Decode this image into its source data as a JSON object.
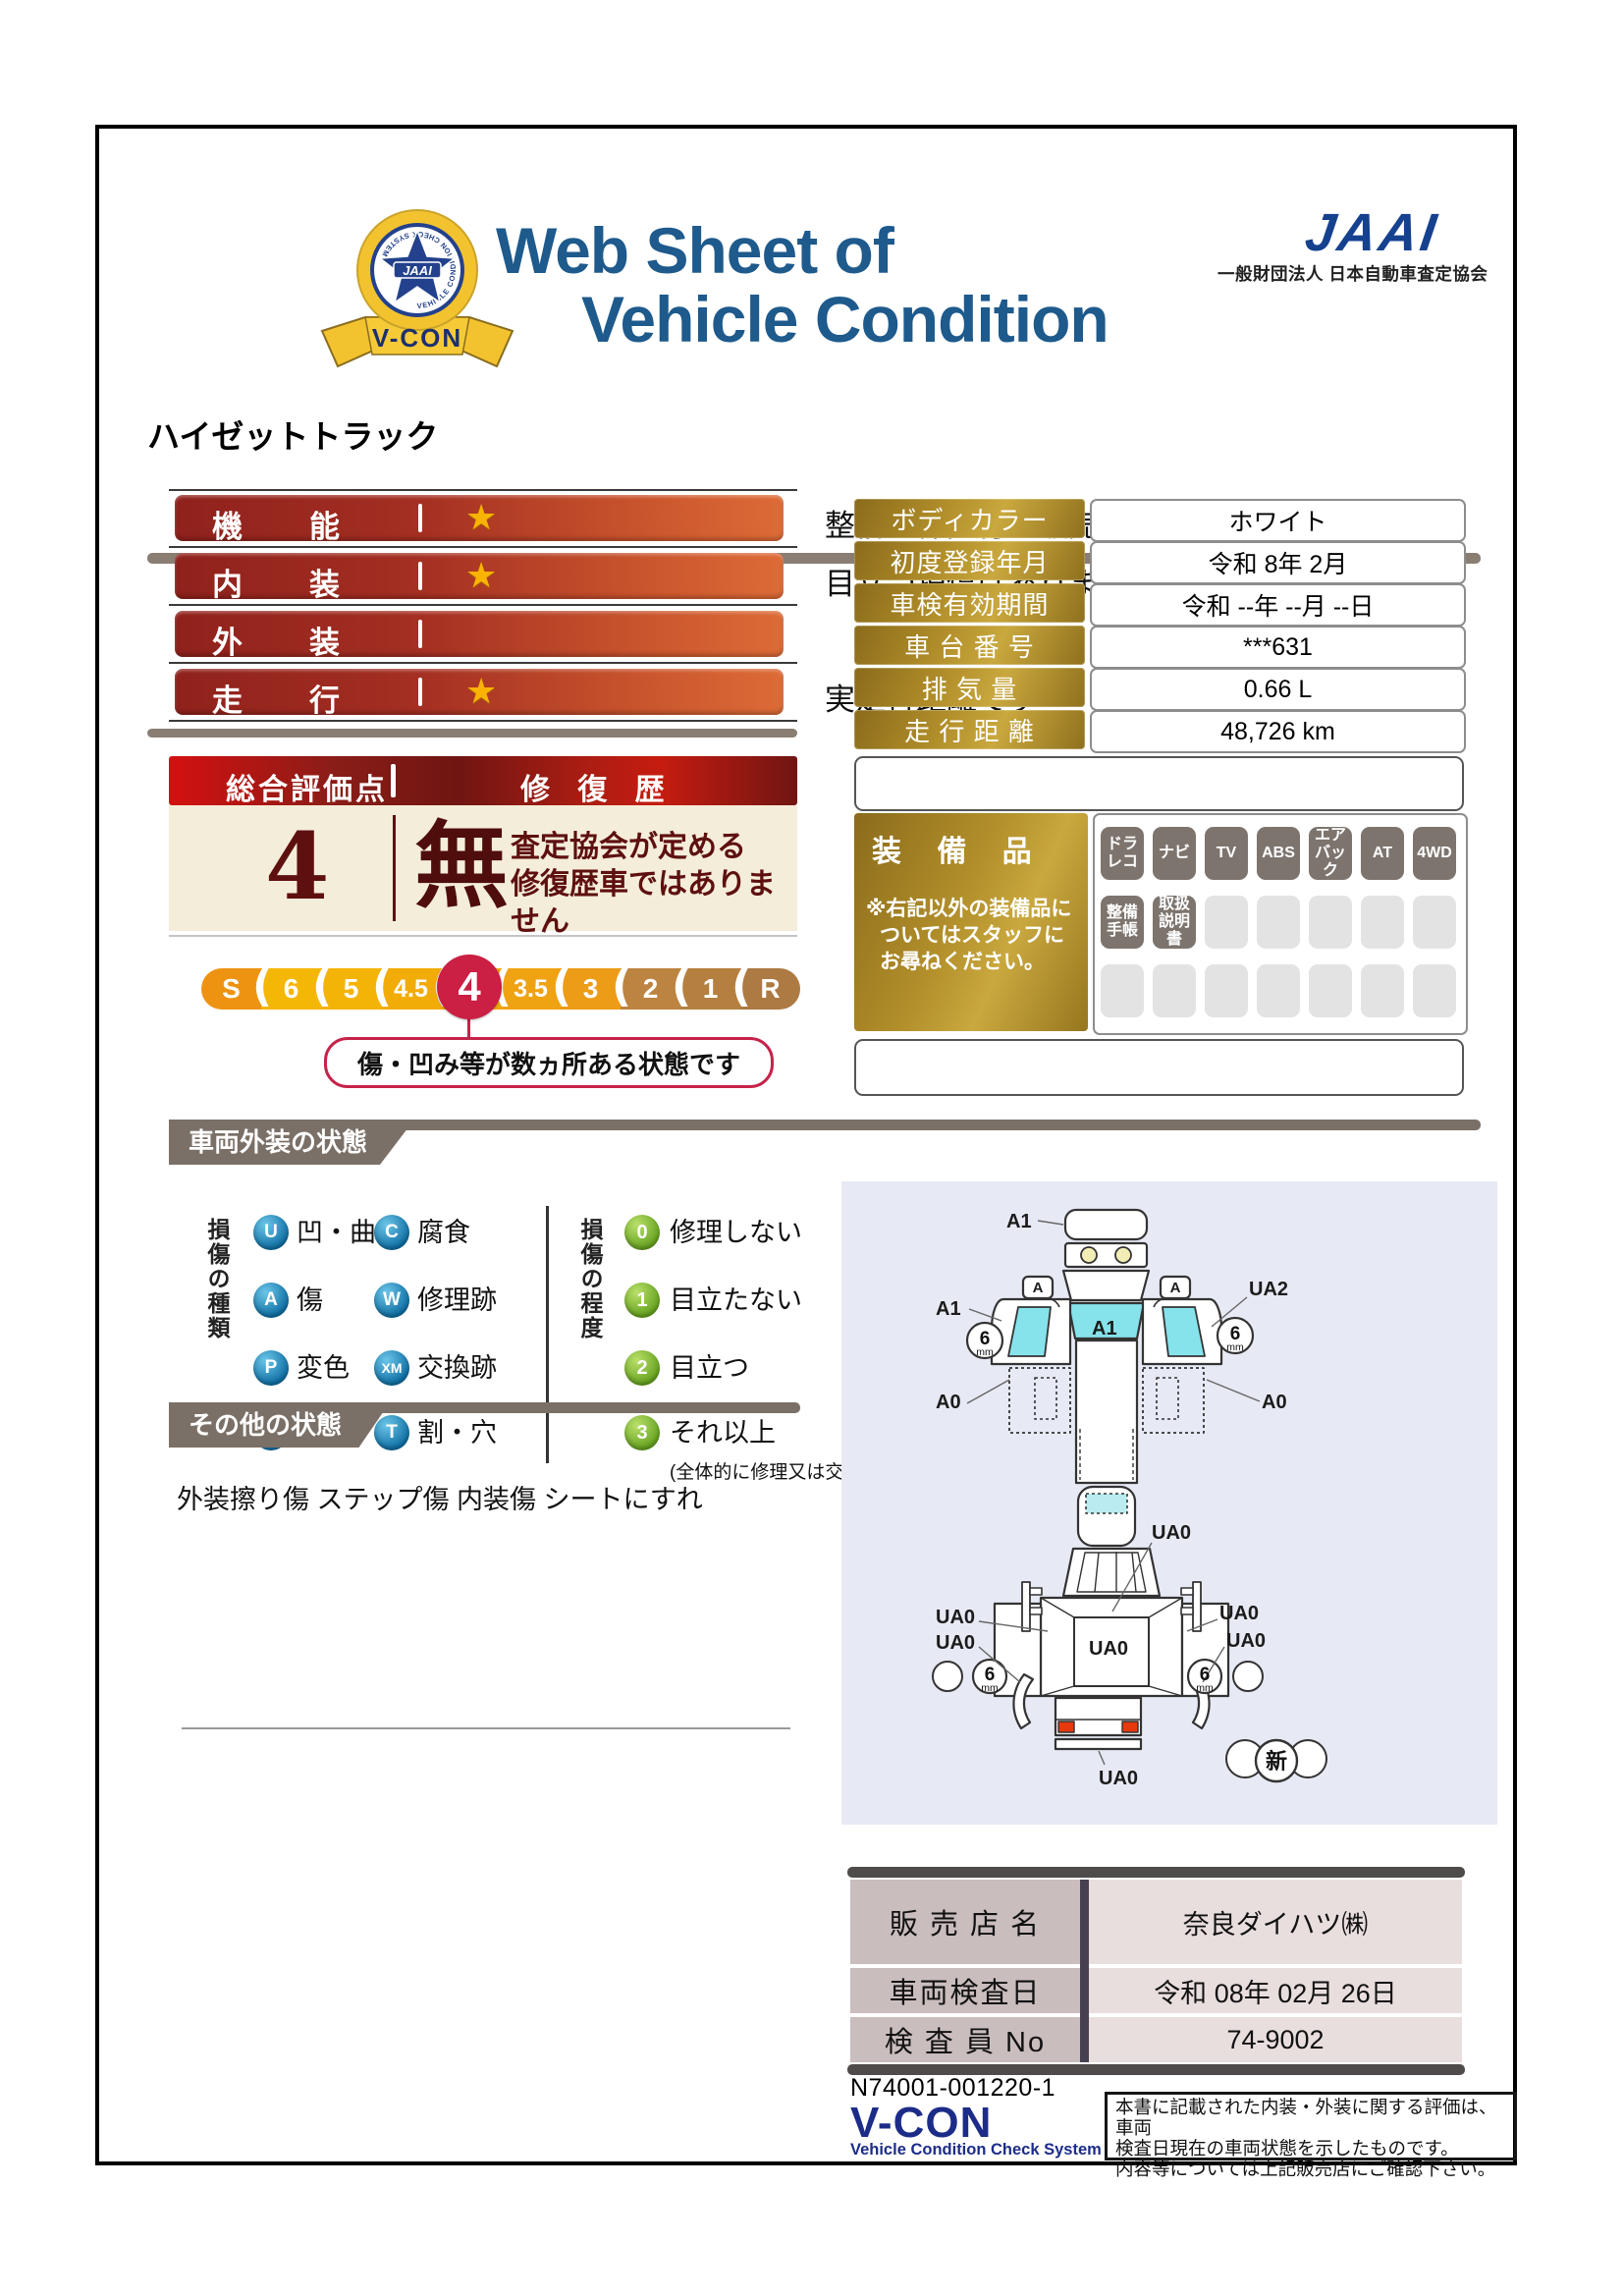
{
  "colors": {
    "navy_title": "#1e5a8c",
    "jaai_blue": "#16418f",
    "bar_red": "#8f211c",
    "bar_orange": "#dd6b37",
    "crimson": "#cb1f43",
    "gold": "#b3902b",
    "tab_gray": "#7b7067",
    "cream": "#f4edda",
    "maroon": "#5e100f",
    "diagram_bg": "#e7e9f4",
    "glass_cyan": "#86e3eb",
    "badge_blue": "#0f6fa4",
    "badge_green": "#66a21f"
  },
  "header": {
    "title_line1": "Web Sheet of",
    "title_line2": "Vehicle Condition",
    "badge": {
      "center": "JAAI",
      "ring_text": "VEHICLE CONDITION CHECK SYSTEM",
      "ribbon": "V-CON"
    },
    "jaai_logo": "JAAI",
    "jaai_org": "一般財団法人 日本自動車査定協会"
  },
  "vehicle_name": "ハイゼットトラック",
  "ratings": {
    "star_glyph": "★",
    "rows": [
      {
        "label": "機能",
        "star": true,
        "comment": "整備・保証付き販売です"
      },
      {
        "label": "内装",
        "star": true,
        "comment": "目立つ損傷はありません"
      },
      {
        "label": "外装",
        "star": false,
        "comment": ""
      },
      {
        "label": "走行",
        "star": true,
        "comment": "実走行距離です"
      }
    ]
  },
  "overall": {
    "header_left": "総合評価点",
    "header_right": "修 復 歴",
    "score": "4",
    "repair_mark": "無",
    "repair_note_line1": "査定協会が定める",
    "repair_note_line2": "修復歴車ではありません",
    "scale": [
      "S",
      "6",
      "5",
      "4.5",
      "4",
      "3.5",
      "3",
      "2",
      "1",
      "R"
    ],
    "selected": "4",
    "callout": "傷・凹み等が数ヵ所ある状態です"
  },
  "info_table": {
    "rows": [
      {
        "label": "ボディカラー",
        "value": "ホワイト"
      },
      {
        "label": "初度登録年月",
        "value": "令和 8年 2月"
      },
      {
        "label": "車検有効期間",
        "value": "令和 --年 --月 --日"
      },
      {
        "label": "車 台 番 号",
        "value": "***631"
      },
      {
        "label": "排 気 量",
        "value": "0.66 L"
      },
      {
        "label": "走 行 距 離",
        "value": "48,726 km"
      }
    ]
  },
  "equipment": {
    "title": "装 備 品",
    "note_line1": "※右記以外の装備品に",
    "note_line2": "ついてはスタッフに",
    "note_line3": "お尋ねください。",
    "active": [
      "ドラ\nレコ",
      "ナビ",
      "TV",
      "ABS",
      "エア\nバック",
      "AT",
      "4WD",
      "整備\n手帳",
      "取扱\n説明書"
    ]
  },
  "exterior": {
    "title": "車両外装の状態",
    "kind_header": "損傷の種類",
    "kinds_col1": [
      {
        "code": "U",
        "label": "凹・曲"
      },
      {
        "code": "A",
        "label": "傷"
      },
      {
        "code": "P",
        "label": "変色"
      },
      {
        "code": "S",
        "label": "さび"
      }
    ],
    "kinds_col2": [
      {
        "code": "C",
        "label": "腐食"
      },
      {
        "code": "W",
        "label": "修理跡"
      },
      {
        "code": "XM",
        "label": "交換跡"
      },
      {
        "code": "T",
        "label": "割・穴"
      }
    ],
    "degree_header": "損傷の程度",
    "degrees": [
      {
        "code": "0",
        "label": "修理しない"
      },
      {
        "code": "1",
        "label": "目立たない"
      },
      {
        "code": "2",
        "label": "目立つ"
      },
      {
        "code": "3",
        "label": "それ以上"
      }
    ],
    "degree_note": "(全体的に修理又は交換が必要)"
  },
  "other": {
    "title": "その他の状態",
    "text": "外装擦り傷 ステップ傷 内装傷 シートにすれ"
  },
  "diagram": {
    "upper": {
      "front": "A1",
      "left": "A1",
      "right": "UA2",
      "windshield": "A1",
      "left_lower": "A0",
      "right_lower": "A0",
      "mirror_left": "A",
      "mirror_right": "A"
    },
    "lower": {
      "top": "UA0",
      "left_upper": "UA0",
      "left_lower": "UA0",
      "bed": "UA0",
      "right_upper": "UA0",
      "right_lower": "UA0",
      "rear": "UA0"
    },
    "tread_value": "6",
    "tread_unit": "mm",
    "new_mark": "新"
  },
  "dealer": {
    "rows": [
      {
        "label": "販 売 店 名",
        "value": "奈良ダイハツ㈱"
      },
      {
        "label": "車両検査日",
        "value": "令和 08年 02月 26日"
      },
      {
        "label": "検 査 員 No",
        "value": "74-9002"
      }
    ]
  },
  "footer": {
    "doc_no": "N74001-001220-1",
    "vcon": "V-CON",
    "vcon_sub": "Vehicle Condition Check System",
    "disclaimer_line1": "本書に記載された内装・外装に関する評価は、車両",
    "disclaimer_line2": "検査日現在の車両状態を示したものです。",
    "disclaimer_line3": "内容等については上記販売店にご確認下さい。"
  }
}
